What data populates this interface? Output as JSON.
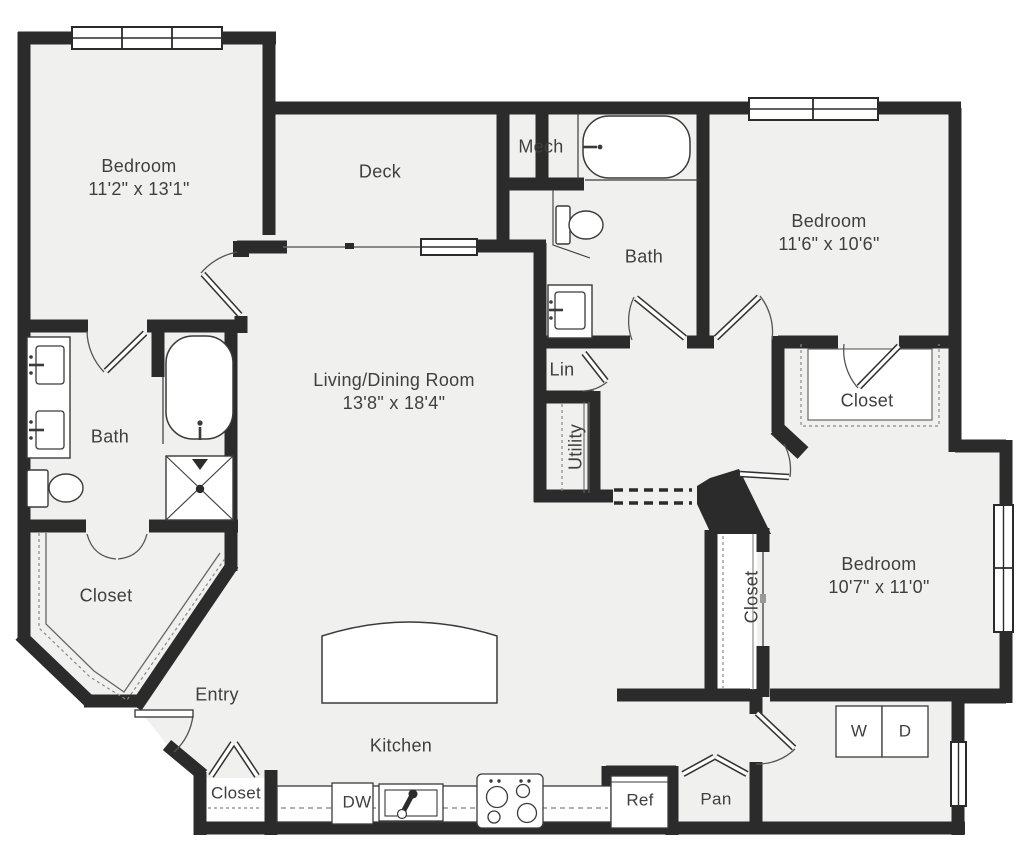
{
  "rooms": {
    "bedroom1": {
      "name": "Bedroom",
      "dims": "11'2\" x 13'1\""
    },
    "deck": {
      "name": "Deck"
    },
    "mech": {
      "name": "Mech"
    },
    "bath_upper": {
      "name": "Bath"
    },
    "bedroom2": {
      "name": "Bedroom",
      "dims": "11'6\" x 10'6\""
    },
    "closet_bedroom2": {
      "name": "Closet"
    },
    "lin": {
      "name": "Lin"
    },
    "utility": {
      "name": "Utility"
    },
    "living": {
      "name": "Living/Dining Room",
      "dims": "13'8\" x 18'4\""
    },
    "bath_master": {
      "name": "Bath"
    },
    "closet_walkin": {
      "name": "Closet"
    },
    "entry": {
      "name": "Entry"
    },
    "kitchen": {
      "name": "Kitchen"
    },
    "closet_entry": {
      "name": "Closet"
    },
    "bedroom3": {
      "name": "Bedroom",
      "dims": "10'7\" x 11'0\""
    },
    "closet_bedroom3": {
      "name": "Closet"
    }
  },
  "appliances": {
    "dishwasher": "DW",
    "refrigerator": "Ref",
    "pantry": "Pan",
    "washer": "W",
    "dryer": "D"
  },
  "colors": {
    "wall": "#2b2b2b",
    "floor": "#f0f0ee",
    "fixture_line": "#3a3a3a",
    "text": "#3f3f3f"
  }
}
